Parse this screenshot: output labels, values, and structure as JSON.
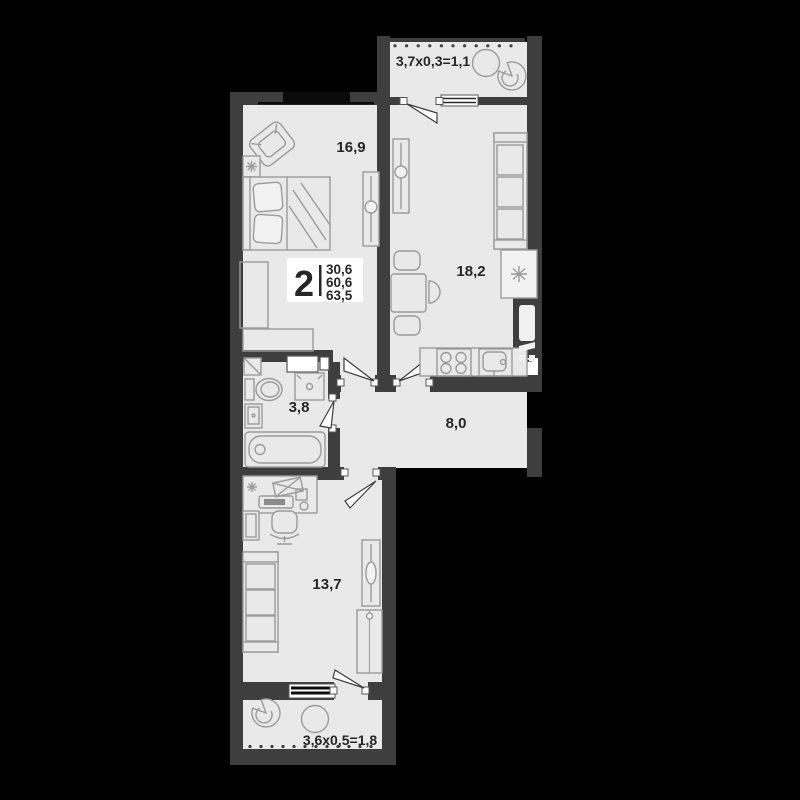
{
  "floorplan": {
    "colors": {
      "background": "#000000",
      "wall": "#3e3e3e",
      "floor": "#e9e9e9",
      "furniture_line": "#9b9b9b",
      "label_text": "#262626",
      "title_box": "#ffffff"
    },
    "title_block": {
      "room_count": "2",
      "areas": {
        "area_1": "30,6",
        "area_2": "60,6",
        "area_3": "63,5"
      }
    },
    "rooms": {
      "bedroom": {
        "area": "16,9"
      },
      "kitchen": {
        "area": "18,2"
      },
      "bathroom": {
        "area": "3,8"
      },
      "hallway": {
        "area": "8,0"
      },
      "living_room": {
        "area": "13,7"
      }
    },
    "balconies": {
      "top": {
        "dimension": "3,7х0,3=1,1"
      },
      "bottom": {
        "dimension": "3,6х0,5=1,8"
      }
    }
  }
}
